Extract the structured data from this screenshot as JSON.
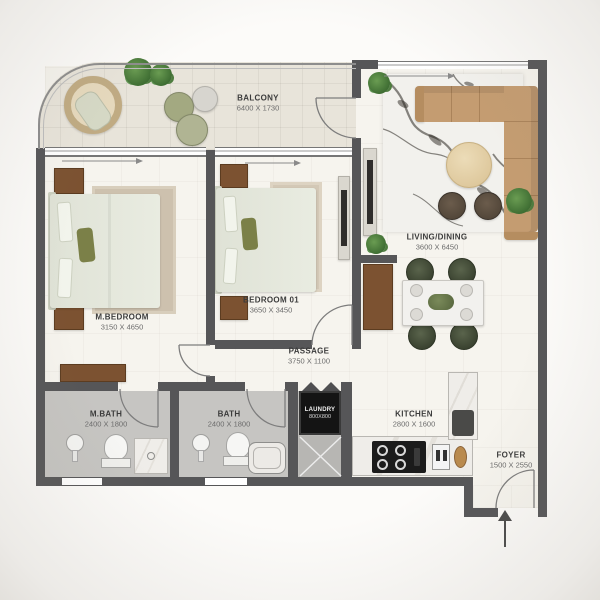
{
  "rooms": [
    {
      "id": "balcony",
      "name": "BALCONY",
      "dims": "6400 X 1730"
    },
    {
      "id": "living_dining",
      "name": "LIVING/DINING",
      "dims": "3600 X 6450"
    },
    {
      "id": "m_bedroom",
      "name": "M.BEDROOM",
      "dims": "3150 X 4650"
    },
    {
      "id": "bedroom_01",
      "name": "BEDROOM 01",
      "dims": "3650 X 3450"
    },
    {
      "id": "passage",
      "name": "PASSAGE",
      "dims": "3750 X 1100"
    },
    {
      "id": "m_bath",
      "name": "M.BATH",
      "dims": "2400 X 1800"
    },
    {
      "id": "bath",
      "name": "BATH",
      "dims": "2400 X 1800"
    },
    {
      "id": "laundry",
      "name": "LAUNDRY",
      "dims": "800X800"
    },
    {
      "id": "kitchen",
      "name": "KITCHEN",
      "dims": "2800 X 1600"
    },
    {
      "id": "foyer",
      "name": "FOYER",
      "dims": "1500 X 2550"
    }
  ],
  "icons": {
    "entry_arrow_icon": "up-triangle",
    "door_swing_icon": "quarter-arc",
    "laundry_bifold_door_icon": "double-peak",
    "closet_x_brace_icon": "x-brace"
  },
  "colors": {
    "wall": "#565658",
    "floor": "#f6f4ee",
    "balcony_tile": "#e8e4da",
    "bath_floor": "#c6c5c2",
    "wood_dark": "#7c5231",
    "sofa_tan": "#c49c71",
    "bedding_sage": "#e6e9dd",
    "accent_olive": "#7b8048",
    "dining_chair_green": "#49523f",
    "plant_green": "#4e7c3f",
    "marble_vein": "#2a2620",
    "washer_black": "#141414",
    "label_text": "#3b3b3b"
  }
}
